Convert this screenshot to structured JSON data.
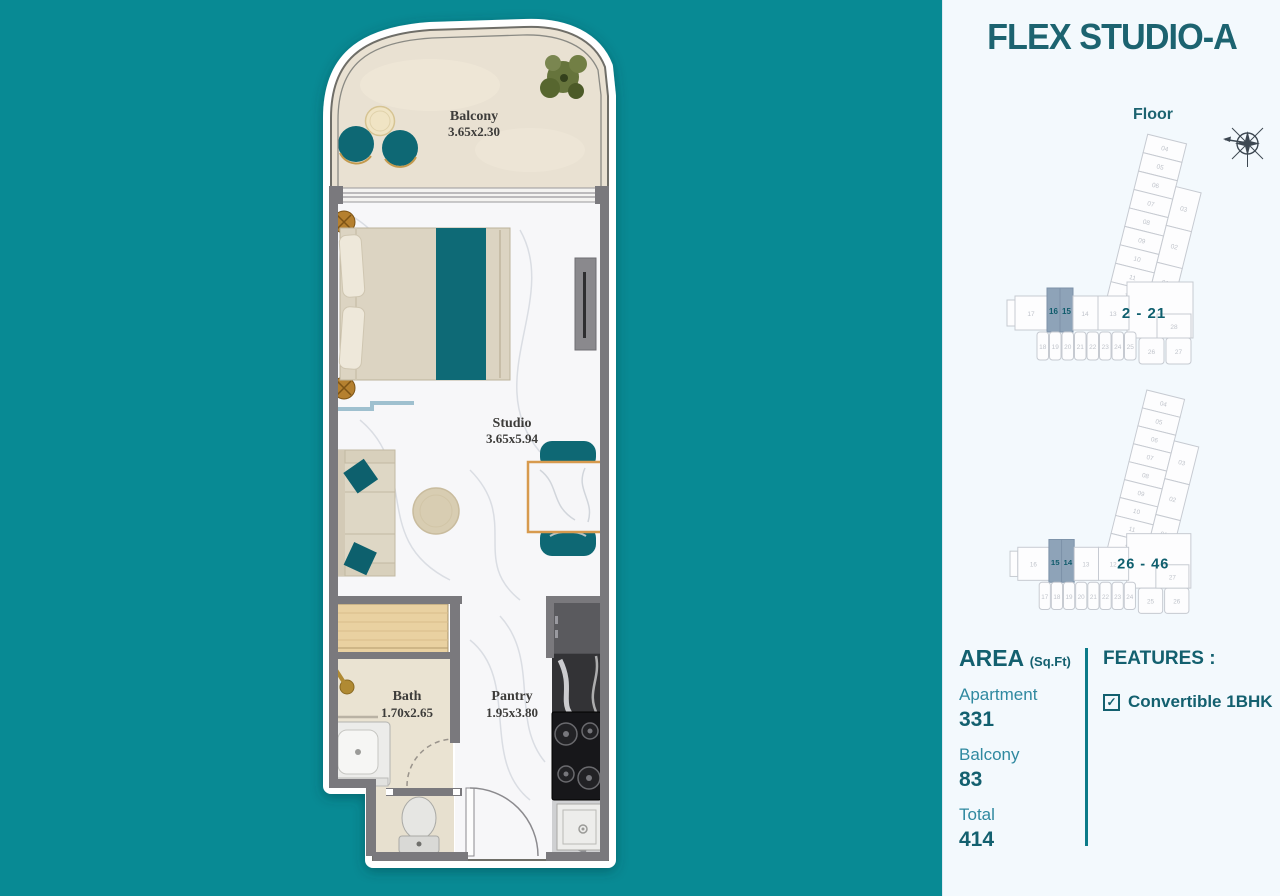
{
  "colors": {
    "background_teal": "#088a94",
    "panel_background": "#f3f9fd",
    "accent_dark_teal": "#13606f",
    "accent_light_teal": "#2f89a0",
    "furniture_teal": "#0e6a76",
    "wall_gray": "#7a797d",
    "highlight_unit": "#8ea3b8",
    "table_border_orange": "#d79a4e"
  },
  "floor_plan": {
    "balcony": {
      "name": "Balcony",
      "dims": "3.65x2.30"
    },
    "studio": {
      "name": "Studio",
      "dims": "3.65x5.94"
    },
    "bath": {
      "name": "Bath",
      "dims": "1.70x2.65"
    },
    "pantry": {
      "name": "Pantry",
      "dims": "1.95x3.80"
    }
  },
  "panel": {
    "title": "FLEX STUDIO-A",
    "floor_label": "Floor",
    "diagrams": [
      {
        "range": "2 - 21",
        "tower": [
          "04",
          "05",
          "06",
          "07",
          "08",
          "09",
          "10",
          "11",
          "12"
        ],
        "side": [
          "03",
          "02",
          "01"
        ],
        "upper_row": [
          "17",
          "16",
          "15",
          "14",
          "13"
        ],
        "highlighted": [
          "16",
          "15"
        ],
        "lower_row": [
          "18",
          "19",
          "20",
          "21",
          "22",
          "23",
          "24",
          "25",
          "26",
          "27"
        ],
        "corner_unit": "28"
      },
      {
        "range": "26 - 46",
        "tower": [
          "04",
          "05",
          "06",
          "07",
          "08",
          "09",
          "10",
          "11",
          "12"
        ],
        "side": [
          "03",
          "02",
          "01"
        ],
        "upper_row": [
          "16",
          "15",
          "14",
          "13",
          "12"
        ],
        "highlighted": [
          "15",
          "14"
        ],
        "lower_row": [
          "17",
          "18",
          "19",
          "20",
          "21",
          "22",
          "23",
          "24",
          "25",
          "26"
        ],
        "corner_unit": "27"
      }
    ],
    "area": {
      "heading": "AREA",
      "heading_unit": "(Sq.Ft)",
      "rows": [
        {
          "label": "Apartment",
          "value": "331"
        },
        {
          "label": "Balcony",
          "value": "83"
        },
        {
          "label": "Total",
          "value": "414"
        }
      ]
    },
    "features": {
      "heading": "FEATURES :",
      "items": [
        {
          "label": "Convertible 1BHK",
          "checked": "✓"
        }
      ]
    }
  }
}
